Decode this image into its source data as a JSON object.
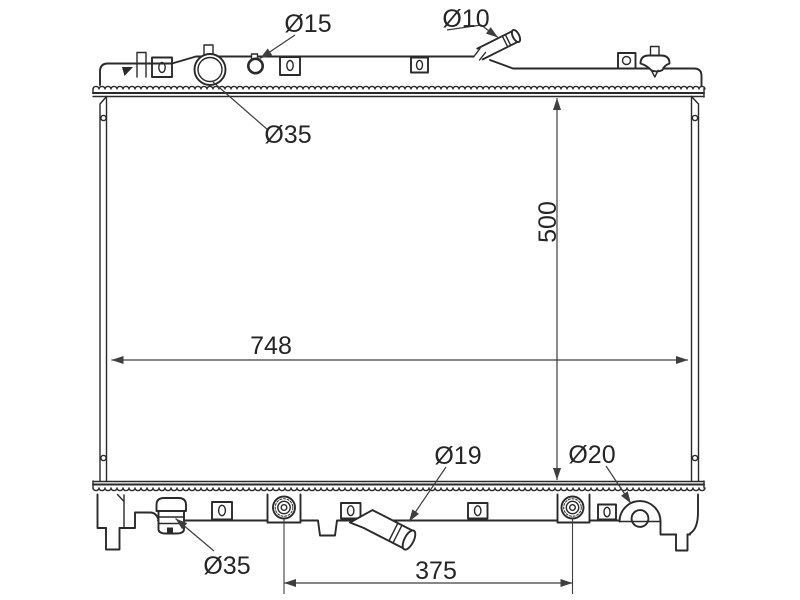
{
  "drawing": {
    "type": "radiator-engineering-diagram",
    "labels": {
      "dia15": "Ø15",
      "dia10": "Ø10",
      "dia35_top": "Ø35",
      "height": "500",
      "width": "748",
      "dia19": "Ø19",
      "dia20": "Ø20",
      "dia35_bottom": "Ø35",
      "pin_span": "375"
    },
    "colors": {
      "outline": "#2a2a2a",
      "dimension": "#3e3e3e",
      "background": "#ffffff"
    }
  }
}
